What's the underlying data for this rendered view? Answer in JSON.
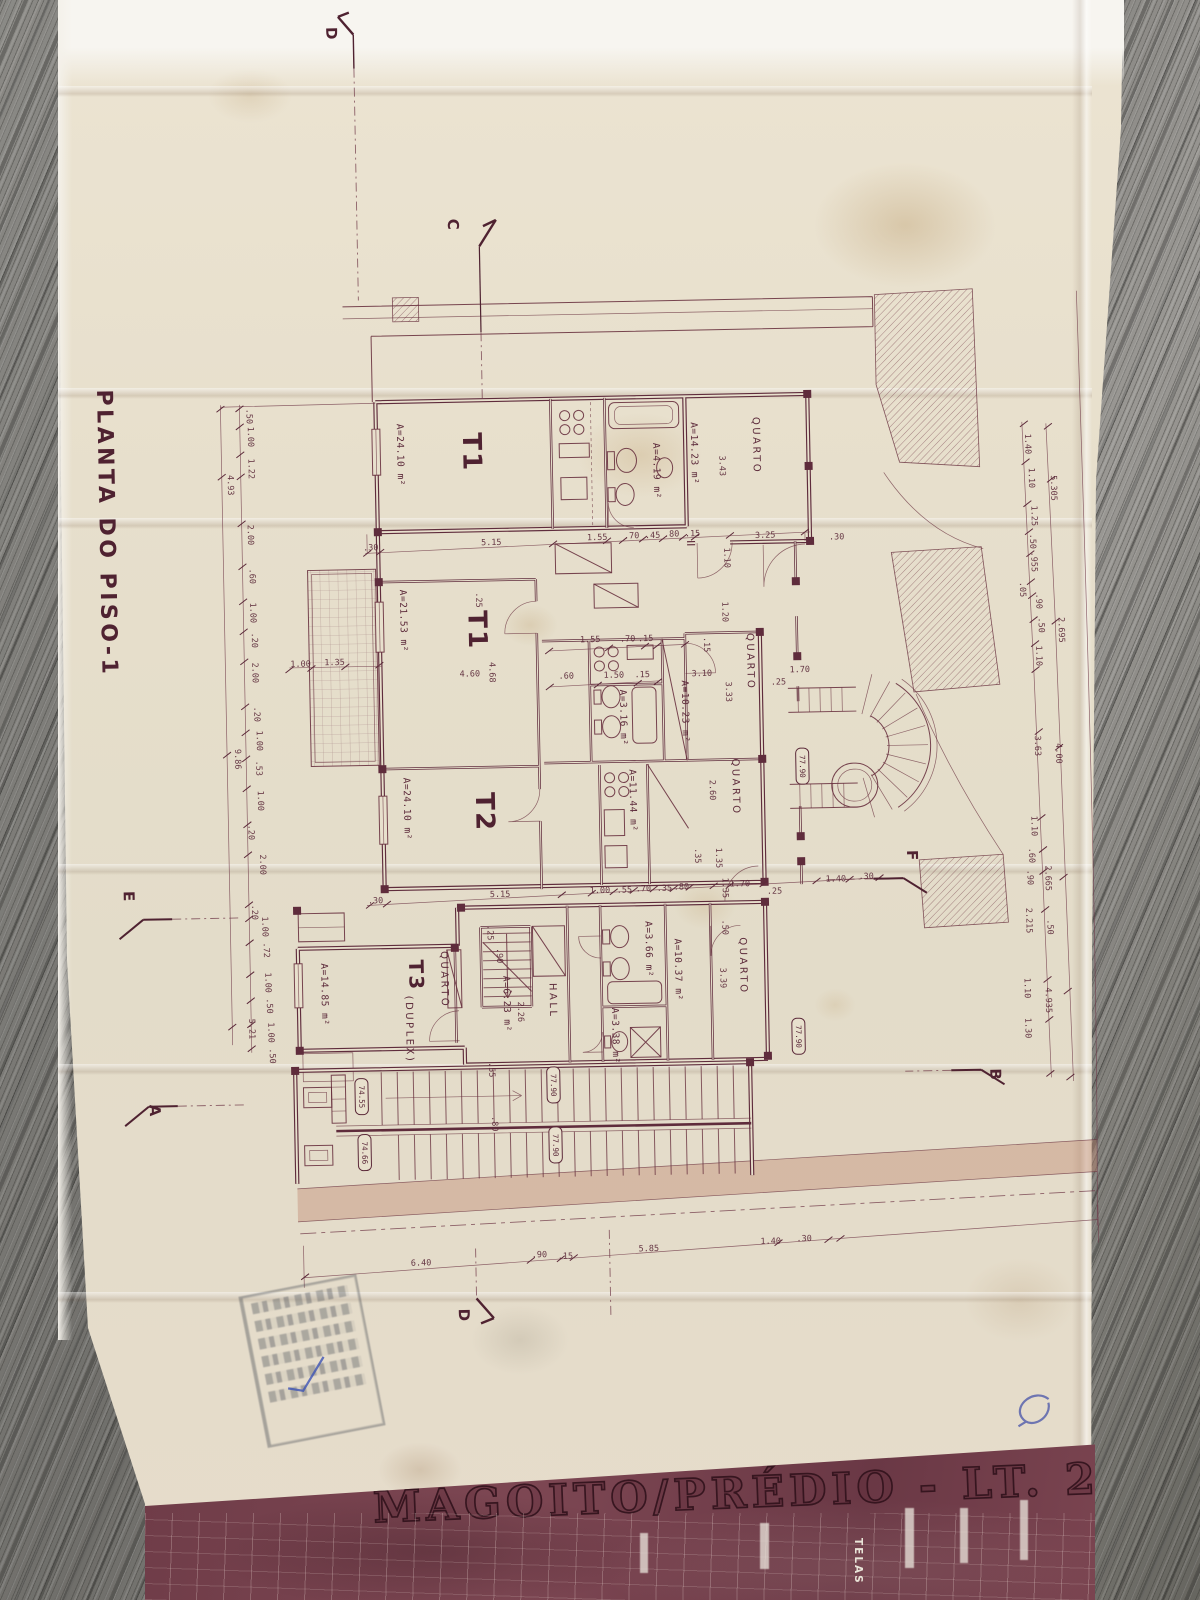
{
  "photo": {
    "surface": "weathered gray wood planks",
    "document": "folded aged architectural drawing, maroon ink on cream tracing paper"
  },
  "colors": {
    "ink": "#5f2c3c",
    "paper": "#e8e0cd",
    "band": "#744350",
    "wood": "#7d7c78",
    "stamp": "#4b505a",
    "pen": "#4553a8"
  },
  "title_block": {
    "project_title": "MAGOITO/PRÉDIO - LT. 2A",
    "vertical_label": "TELAS"
  },
  "stamp": {
    "present": true,
    "legible": false
  },
  "plan": {
    "labels": [
      {
        "t": "PLANTA DO PISO-1",
        "x": 105,
        "y": 380,
        "r": 90,
        "s": 22,
        "b": 1,
        "k": "title"
      },
      {
        "t": "D",
        "x": 341,
        "y": 22,
        "r": 90,
        "s": 15,
        "b": 1,
        "k": "marker"
      },
      {
        "t": "C",
        "x": 459,
        "y": 216,
        "r": 90,
        "s": 15,
        "b": 1,
        "k": "marker"
      },
      {
        "t": "E",
        "x": 122,
        "y": 882,
        "r": 90,
        "s": 15,
        "b": 1,
        "k": "marker"
      },
      {
        "t": "F",
        "x": 906,
        "y": 856,
        "r": 90,
        "s": 15,
        "b": 1,
        "k": "marker"
      },
      {
        "t": "A",
        "x": 144,
        "y": 1096,
        "r": 90,
        "s": 15,
        "b": 1,
        "k": "marker"
      },
      {
        "t": "B",
        "x": 985,
        "y": 1076,
        "r": 90,
        "s": 15,
        "b": 1,
        "k": "marker"
      },
      {
        "t": "D",
        "x": 449,
        "y": 1306,
        "r": 90,
        "s": 15,
        "b": 1,
        "k": "marker"
      },
      {
        "t": "T1",
        "x": 470,
        "y": 430,
        "r": 90,
        "s": 26,
        "b": 1,
        "k": "unit"
      },
      {
        "t": "T1",
        "x": 472,
        "y": 608,
        "r": 90,
        "s": 26,
        "b": 1,
        "k": "unit"
      },
      {
        "t": "T2",
        "x": 476,
        "y": 790,
        "r": 90,
        "s": 26,
        "b": 1,
        "k": "unit"
      },
      {
        "t": "T3",
        "x": 406,
        "y": 956,
        "r": 90,
        "s": 20,
        "b": 1,
        "k": "unit"
      },
      {
        "t": "(DUPLEX)",
        "x": 402,
        "y": 992,
        "r": 90,
        "s": 8.5,
        "k": "room"
      },
      {
        "t": "A=24.10 m²",
        "x": 404,
        "y": 420,
        "r": 90,
        "k": "area"
      },
      {
        "t": "A=14.23 m²",
        "x": 698,
        "y": 424,
        "r": 90,
        "k": "area"
      },
      {
        "t": "A=4.19 m²",
        "x": 660,
        "y": 444,
        "r": 90,
        "s": 8,
        "k": "area"
      },
      {
        "t": "A=21.53 m²",
        "x": 404,
        "y": 586,
        "r": 90,
        "k": "area"
      },
      {
        "t": "A=3.16 m²",
        "x": 622,
        "y": 690,
        "r": 90,
        "s": 8,
        "k": "area"
      },
      {
        "t": "A=10.23 m²",
        "x": 684,
        "y": 682,
        "r": 90,
        "k": "area"
      },
      {
        "t": "A=11.44 m²",
        "x": 630,
        "y": 770,
        "r": 90,
        "k": "area"
      },
      {
        "t": "A=24.10 m²",
        "x": 404,
        "y": 774,
        "r": 90,
        "k": "area"
      },
      {
        "t": "A=14.85 m²",
        "x": 318,
        "y": 958,
        "r": 90,
        "k": "area"
      },
      {
        "t": "A=6.23 m²",
        "x": 500,
        "y": 974,
        "r": 90,
        "s": 8.5,
        "k": "area"
      },
      {
        "t": "A=10.37 m²",
        "x": 672,
        "y": 940,
        "r": 90,
        "k": "area"
      },
      {
        "t": "A=3.66 m²",
        "x": 643,
        "y": 922,
        "r": 90,
        "s": 8,
        "k": "area"
      },
      {
        "t": "A=3.38 m²",
        "x": 608,
        "y": 1008,
        "r": 90,
        "s": 8,
        "k": "area"
      },
      {
        "t": "QUARTO",
        "x": 760,
        "y": 420,
        "r": 90,
        "k": "room"
      },
      {
        "t": "QUARTO",
        "x": 750,
        "y": 636,
        "r": 90,
        "k": "room"
      },
      {
        "t": "QUARTO",
        "x": 733,
        "y": 761,
        "r": 90,
        "k": "room"
      },
      {
        "t": "QUARTO",
        "x": 438,
        "y": 948,
        "r": 90,
        "k": "room"
      },
      {
        "t": "QUARTO",
        "x": 737,
        "y": 940,
        "r": 90,
        "k": "room"
      },
      {
        "t": "HALL",
        "x": 546,
        "y": 982,
        "r": 90,
        "k": "room"
      },
      {
        "t": ".30",
        "x": 368,
        "y": 546
      },
      {
        "t": "5.15",
        "x": 486,
        "y": 543
      },
      {
        "t": "1.55",
        "x": 592,
        "y": 540
      },
      {
        "t": ".70",
        "x": 629,
        "y": 539
      },
      {
        "t": ".45",
        "x": 650,
        "y": 539
      },
      {
        "t": ".80",
        "x": 669,
        "y": 538
      },
      {
        "t": ".15",
        "x": 690,
        "y": 538
      },
      {
        "t": "3.25",
        "x": 760,
        "y": 541
      },
      {
        "t": ".30",
        "x": 834,
        "y": 544
      },
      {
        "t": "4.60",
        "x": 462,
        "y": 674
      },
      {
        "t": "1.55",
        "x": 583,
        "y": 642
      },
      {
        "t": ".70",
        "x": 623,
        "y": 642
      },
      {
        "t": ".15",
        "x": 641,
        "y": 642
      },
      {
        "t": ".60",
        "x": 561,
        "y": 678
      },
      {
        "t": "1.50",
        "x": 606,
        "y": 678
      },
      {
        "t": ".15",
        "x": 637,
        "y": 678
      },
      {
        "t": "3.10",
        "x": 694,
        "y": 678
      },
      {
        "t": "1.70",
        "x": 792,
        "y": 676
      },
      {
        "t": ".25",
        "x": 773,
        "y": 688
      },
      {
        "t": "1.00",
        "x": 293,
        "y": 661
      },
      {
        "t": "1.35",
        "x": 327,
        "y": 660
      },
      {
        "t": ".30",
        "x": 366,
        "y": 899
      },
      {
        "t": "5.15",
        "x": 488,
        "y": 895
      },
      {
        "t": "1.00",
        "x": 588,
        "y": 893
      },
      {
        "t": ".55",
        "x": 615,
        "y": 893
      },
      {
        "t": ".70",
        "x": 634,
        "y": 892
      },
      {
        "t": ".35",
        "x": 655,
        "y": 892
      },
      {
        "t": ".80",
        "x": 672,
        "y": 891
      },
      {
        "t": "1.70",
        "x": 728,
        "y": 889
      },
      {
        "t": ".25",
        "x": 765,
        "y": 897
      },
      {
        "t": "1.40",
        "x": 824,
        "y": 886
      },
      {
        "t": ".30",
        "x": 857,
        "y": 884
      },
      {
        "t": "6.40",
        "x": 402,
        "y": 1262
      },
      {
        "t": ".90",
        "x": 523,
        "y": 1256
      },
      {
        "t": ".15",
        "x": 549,
        "y": 1258
      },
      {
        "t": "5.85",
        "x": 630,
        "y": 1252
      },
      {
        "t": "1.40",
        "x": 752,
        "y": 1247
      },
      {
        "t": ".30",
        "x": 788,
        "y": 1245
      },
      {
        "t": ".50",
        "x": 254,
        "y": 402,
        "r": 90
      },
      {
        "t": "1.00",
        "x": 255,
        "y": 420,
        "r": 90
      },
      {
        "t": "1.22",
        "x": 255,
        "y": 452,
        "r": 90
      },
      {
        "t": "4.93",
        "x": 234,
        "y": 468,
        "r": 90
      },
      {
        "t": "2.00",
        "x": 253,
        "y": 518,
        "r": 90
      },
      {
        "t": ".60",
        "x": 254,
        "y": 562,
        "r": 90
      },
      {
        "t": "1.00",
        "x": 254,
        "y": 596,
        "r": 90
      },
      {
        "t": ".20",
        "x": 255,
        "y": 626,
        "r": 90
      },
      {
        "t": "2.00",
        "x": 255,
        "y": 656,
        "r": 90
      },
      {
        "t": ".20",
        "x": 256,
        "y": 700,
        "r": 90
      },
      {
        "t": "1.00",
        "x": 258,
        "y": 724,
        "r": 90
      },
      {
        "t": "9.86",
        "x": 236,
        "y": 742,
        "r": 90
      },
      {
        "t": ".53",
        "x": 257,
        "y": 754,
        "r": 90
      },
      {
        "t": "1.00",
        "x": 258,
        "y": 784,
        "r": 90
      },
      {
        "t": ".20",
        "x": 248,
        "y": 818,
        "r": 90
      },
      {
        "t": "2.00",
        "x": 259,
        "y": 848,
        "r": 90
      },
      {
        "t": ".20",
        "x": 250,
        "y": 898,
        "r": 90
      },
      {
        "t": "1.00",
        "x": 260,
        "y": 910,
        "r": 90
      },
      {
        "t": ".72",
        "x": 261,
        "y": 936,
        "r": 90
      },
      {
        "t": "1.00",
        "x": 262,
        "y": 966,
        "r": 90
      },
      {
        "t": ".50",
        "x": 263,
        "y": 992,
        "r": 90
      },
      {
        "t": "5.21",
        "x": 245,
        "y": 1012,
        "r": 90
      },
      {
        "t": "1.00",
        "x": 264,
        "y": 1016,
        "r": 90
      },
      {
        "t": ".50",
        "x": 265,
        "y": 1042,
        "r": 90
      },
      {
        "t": "4.68",
        "x": 492,
        "y": 660,
        "r": 90
      },
      {
        "t": ".25",
        "x": 480,
        "y": 590,
        "r": 90
      },
      {
        "t": "3.43",
        "x": 726,
        "y": 458,
        "r": 90
      },
      {
        "t": "1.10",
        "x": 729,
        "y": 550,
        "r": 90
      },
      {
        "t": "1.20",
        "x": 726,
        "y": 604,
        "r": 90
      },
      {
        "t": ".15",
        "x": 707,
        "y": 639,
        "r": 90
      },
      {
        "t": "3.33",
        "x": 728,
        "y": 684,
        "r": 90
      },
      {
        "t": "2.60",
        "x": 710,
        "y": 782,
        "r": 90
      },
      {
        "t": ".35",
        "x": 694,
        "y": 850,
        "r": 90
      },
      {
        "t": "1.35",
        "x": 715,
        "y": 850,
        "r": 90
      },
      {
        "t": "1.35",
        "x": 721,
        "y": 880,
        "r": 90
      },
      {
        "t": ".50",
        "x": 720,
        "y": 922,
        "r": 90
      },
      {
        "t": ".25",
        "x": 485,
        "y": 923,
        "r": 90
      },
      {
        "t": ".90",
        "x": 494,
        "y": 946,
        "r": 90
      },
      {
        "t": "2.26",
        "x": 514,
        "y": 1000,
        "r": 90
      },
      {
        "t": "3.39",
        "x": 717,
        "y": 970,
        "r": 90
      },
      {
        "t": ".55",
        "x": 484,
        "y": 1060,
        "r": 90
      },
      {
        "t": ".80",
        "x": 486,
        "y": 1114,
        "r": 90
      },
      {
        "t": "1.40",
        "x": 1032,
        "y": 442,
        "r": 90
      },
      {
        "t": "1.10",
        "x": 1035,
        "y": 476,
        "r": 90
      },
      {
        "t": "5.305",
        "x": 1057,
        "y": 484,
        "r": 90
      },
      {
        "t": "1.25",
        "x": 1037,
        "y": 514,
        "r": 90
      },
      {
        "t": ".50",
        "x": 1035,
        "y": 542,
        "r": 90
      },
      {
        "t": ".955",
        "x": 1036,
        "y": 560,
        "r": 90
      },
      {
        "t": ".05",
        "x": 1024,
        "y": 590,
        "r": 90
      },
      {
        "t": ".90",
        "x": 1040,
        "y": 602,
        "r": 90
      },
      {
        "t": ".50",
        "x": 1042,
        "y": 626,
        "r": 90
      },
      {
        "t": "2.695",
        "x": 1062,
        "y": 626,
        "r": 90
      },
      {
        "t": "1.10",
        "x": 1039,
        "y": 654,
        "r": 90
      },
      {
        "t": "3.63",
        "x": 1036,
        "y": 744,
        "r": 90
      },
      {
        "t": "4.00",
        "x": 1057,
        "y": 752,
        "r": 90
      },
      {
        "t": "1.10",
        "x": 1031,
        "y": 824,
        "r": 90
      },
      {
        "t": ".60",
        "x": 1028,
        "y": 856,
        "r": 90
      },
      {
        "t": ".90",
        "x": 1026,
        "y": 878,
        "r": 90
      },
      {
        "t": "2.665",
        "x": 1044,
        "y": 874,
        "r": 90
      },
      {
        "t": "2.215",
        "x": 1024,
        "y": 916,
        "r": 90
      },
      {
        "t": ".50",
        "x": 1045,
        "y": 928,
        "r": 90
      },
      {
        "t": "1.10",
        "x": 1021,
        "y": 986,
        "r": 90
      },
      {
        "t": "4.935",
        "x": 1042,
        "y": 996,
        "r": 90
      },
      {
        "t": "1.30",
        "x": 1021,
        "y": 1026,
        "r": 90
      }
    ],
    "level_markers": [
      {
        "t": "77.90",
        "x": 803,
        "y": 752
      },
      {
        "t": "77.90",
        "x": 794,
        "y": 1022
      },
      {
        "t": "77.90",
        "x": 548,
        "y": 1066
      },
      {
        "t": "77.90",
        "x": 549,
        "y": 1126
      },
      {
        "t": "74.55",
        "x": 356,
        "y": 1074
      },
      {
        "t": "74.66",
        "x": 358,
        "y": 1130
      }
    ],
    "ticks": [
      [
        247,
        402
      ],
      [
        247,
        420
      ],
      [
        247,
        448
      ],
      [
        247,
        470
      ],
      [
        247,
        517
      ],
      [
        247,
        560
      ],
      [
        247,
        595
      ],
      [
        247,
        625
      ],
      [
        247,
        655
      ],
      [
        247,
        700
      ],
      [
        247,
        726
      ],
      [
        247,
        752
      ],
      [
        247,
        782
      ],
      [
        247,
        818
      ],
      [
        247,
        848
      ],
      [
        247,
        898
      ],
      [
        247,
        912
      ],
      [
        247,
        936
      ],
      [
        247,
        968
      ],
      [
        247,
        994
      ],
      [
        247,
        1018
      ],
      [
        247,
        1042
      ],
      [
        228,
        402
      ],
      [
        228,
        470
      ],
      [
        228,
        748
      ],
      [
        228,
        1020
      ],
      [
        1031,
        432
      ],
      [
        1032,
        470
      ],
      [
        1033,
        512
      ],
      [
        1034,
        540
      ],
      [
        1035,
        562
      ],
      [
        1035,
        590
      ],
      [
        1036,
        604
      ],
      [
        1037,
        628
      ],
      [
        1038,
        652
      ],
      [
        1038,
        678
      ],
      [
        1040,
        740
      ],
      [
        1041,
        826
      ],
      [
        1042,
        858
      ],
      [
        1042,
        880
      ],
      [
        1043,
        918
      ],
      [
        1044,
        988
      ],
      [
        1045,
        1028
      ],
      [
        1045,
        1082
      ],
      [
        1055,
        435
      ],
      [
        1057,
        488
      ],
      [
        1059,
        630
      ],
      [
        1060,
        756
      ],
      [
        1062,
        886
      ],
      [
        1064,
        1000
      ],
      [
        1065,
        1086
      ],
      [
        372,
        549
      ],
      [
        385,
        548
      ],
      [
        558,
        543
      ],
      [
        612,
        541
      ],
      [
        628,
        541
      ],
      [
        648,
        540
      ],
      [
        668,
        540
      ],
      [
        688,
        539
      ],
      [
        700,
        539
      ],
      [
        735,
        538
      ],
      [
        810,
        536
      ],
      [
        552,
        650
      ],
      [
        612,
        648
      ],
      [
        648,
        647
      ],
      [
        660,
        647
      ],
      [
        688,
        646
      ],
      [
        552,
        686
      ],
      [
        600,
        685
      ],
      [
        640,
        684
      ],
      [
        660,
        683
      ],
      [
        368,
        901
      ],
      [
        385,
        900
      ],
      [
        560,
        894
      ],
      [
        590,
        893
      ],
      [
        612,
        892
      ],
      [
        632,
        891
      ],
      [
        652,
        890
      ],
      [
        672,
        890
      ],
      [
        688,
        889
      ],
      [
        712,
        888
      ],
      [
        728,
        888
      ],
      [
        762,
        887
      ],
      [
        815,
        885
      ],
      [
        848,
        884
      ],
      [
        878,
        883
      ],
      [
        296,
        1271
      ],
      [
        522,
        1259
      ],
      [
        552,
        1258
      ],
      [
        565,
        1257
      ],
      [
        770,
        1246
      ],
      [
        820,
        1244
      ],
      [
        832,
        1243
      ],
      [
        292,
        664
      ],
      [
        314,
        663
      ],
      [
        348,
        662
      ],
      [
        382,
        661
      ]
    ]
  }
}
